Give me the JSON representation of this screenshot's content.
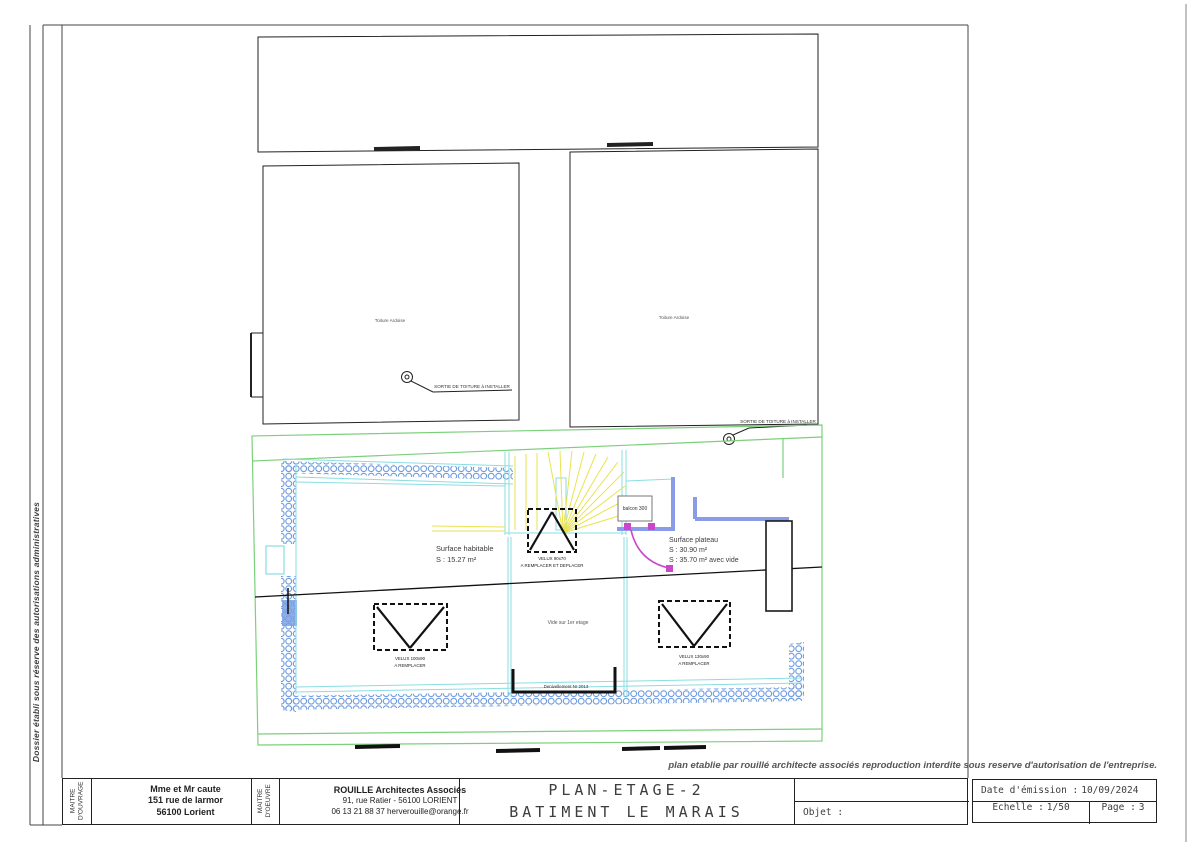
{
  "sheet": {
    "side_note": "Dossier établi sous réserve des autorisations administratives",
    "disclaimer": "plan etablie par rouillé architecte associés reproduction interdite sous reserve d'autorisation de l'entreprise."
  },
  "title_block": {
    "maitre_ouvrage": {
      "label_l1": "MAITRE",
      "label_l2": "D'OUVRAGE",
      "line1": "Mme et Mr caute",
      "line2": "151 rue de larmor",
      "line3": "56100 Lorient"
    },
    "maitre_oeuvre": {
      "label_l1": "MAITRE",
      "label_l2": "D'OEUVRE",
      "line1": "ROUILLE Architectes Associés",
      "line2": "91, rue Ratier - 56100 LORIENT",
      "line3": "06 13 21 88 37 herverouille@orange.fr"
    },
    "title_line1": "PLAN-ETAGE-2",
    "title_line2": "BATIMENT LE MARAIS",
    "objet_label": "Objet :",
    "date_label": "Date d'émission :",
    "date_value": "10/09/2024",
    "echelle_label": "Echelle :",
    "echelle_value": "1/50",
    "page_label": "Page :",
    "page_value": "3"
  },
  "plan": {
    "toiture_label": "Toiture Ardoise",
    "sortie_toiture_label": "SORTIE DE TOITURE à INSTALLER",
    "surface_habitable_l1": "Surface habitable",
    "surface_habitable_l2": "S : 15.27 m²",
    "surface_plateau_l1": "Surface plateau",
    "surface_plateau_l2": "S : 30.90 m²",
    "surface_plateau_l3": "S : 35.70 m² avec vide",
    "balcon_label": "balcon 300",
    "velux_stair_l1": "VELUX 90x70",
    "velux_stair_l2": "A REMPLACER ET DEPLACER",
    "velux_left_l1": "VELUX 100x90",
    "velux_left_l2": "A REMPLACER",
    "velux_right_l1": "VELUX 130x90",
    "velux_right_l2": "A REMPLACER",
    "vide_label": "Vide sur 1er etage",
    "garde_corps_label": "Denivellement Nr 2013"
  },
  "colors": {
    "line_green": "#7cd07c",
    "line_cyan": "#8adde2",
    "line_yellow": "#e9e34f",
    "hatch_blue": "#6f9be0",
    "wall_periwinkle": "#8a9be8",
    "door_magenta": "#cb46cb",
    "ink": "#222222"
  }
}
